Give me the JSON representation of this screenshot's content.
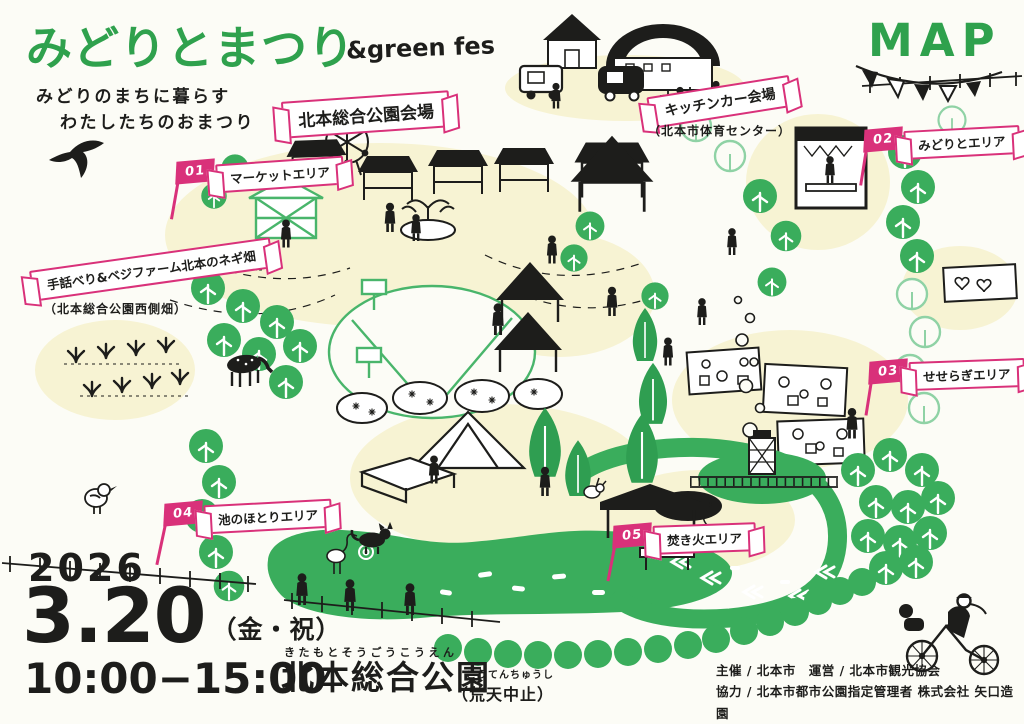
{
  "header": {
    "title": "みどりとまつり",
    "title_suffix": "&green fes",
    "subtitle_line1": "みどりのまちに暮らす",
    "subtitle_line2": "わたしたちのおまつり",
    "map_label": "MAP"
  },
  "banners": {
    "venue": "北本総合公園会場",
    "kitchen": "キッチンカー会場",
    "kitchen_sub": "（北本市体育センター）",
    "negi": "手話べり&ベジファーム北本のネギ畑",
    "negi_sub": "（北本総合公園西側畑）"
  },
  "areas": [
    {
      "no": "01",
      "label": "マーケットエリア"
    },
    {
      "no": "02",
      "label": "みどりとエリア"
    },
    {
      "no": "03",
      "label": "せせらぎエリア"
    },
    {
      "no": "04",
      "label": "池のほとりエリア"
    },
    {
      "no": "05",
      "label": "焚き火エリア"
    }
  ],
  "event": {
    "year": "2026",
    "day": "3.20",
    "day_note": "（金・祝）",
    "time": "10:00−15:00",
    "venue_furigana": "きたもとそうごうこうえん",
    "venue_name": "北本総合公園",
    "cancel_furigana": "こうてんちゅうし",
    "cancel_note": "（荒天中止）"
  },
  "credits": {
    "line1": "主催 / 北本市　運営 / 北本市観光協会",
    "line2": "協力 / 北本市都市公園指定管理者 株式会社 矢口造園"
  },
  "colors": {
    "green": "#2fa14d",
    "tree": "#3aad5c",
    "pink": "#d9317a",
    "yellow": "#f7f3d3",
    "ink": "#1d1d1b"
  }
}
